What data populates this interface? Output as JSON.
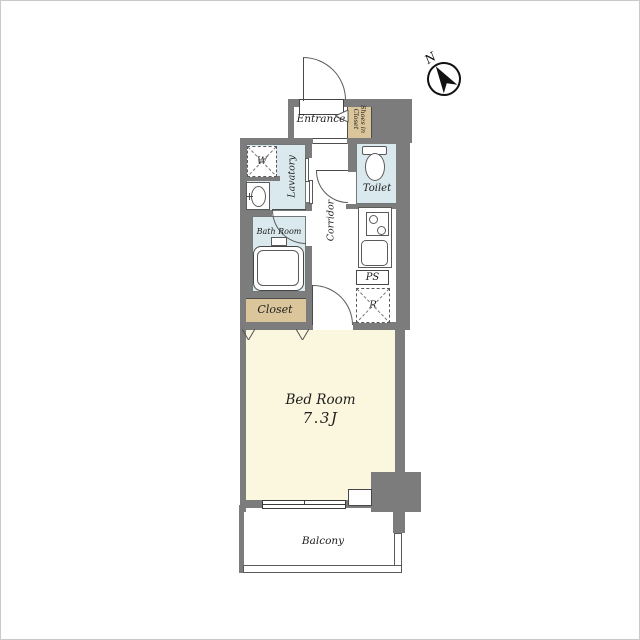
{
  "compass": {
    "label": "N"
  },
  "rooms": {
    "entrance": {
      "label": "Entrance"
    },
    "shoes_in_closet": {
      "line1": "Shoes in",
      "line2": "Closet"
    },
    "lavatory": {
      "label": "Lavatory"
    },
    "toilet": {
      "label": "Toilet"
    },
    "bath_room": {
      "label": "Bath Room"
    },
    "corridor": {
      "label": "Corridor"
    },
    "closet": {
      "label": "Closet"
    },
    "bed_room": {
      "label": "Bed Room",
      "area": "7.3J"
    },
    "balcony": {
      "label": "Balcony"
    }
  },
  "fixtures": {
    "washing_machine": {
      "label": "W"
    },
    "pipe_space": {
      "label": "PS"
    },
    "refrigerator": {
      "label": "R"
    }
  },
  "colors": {
    "wall": "#7c7c7c",
    "wet": "#d9e9ee",
    "tan": "#dbc69b",
    "cream": "#fbf7de",
    "line": "#3d3d3d"
  }
}
